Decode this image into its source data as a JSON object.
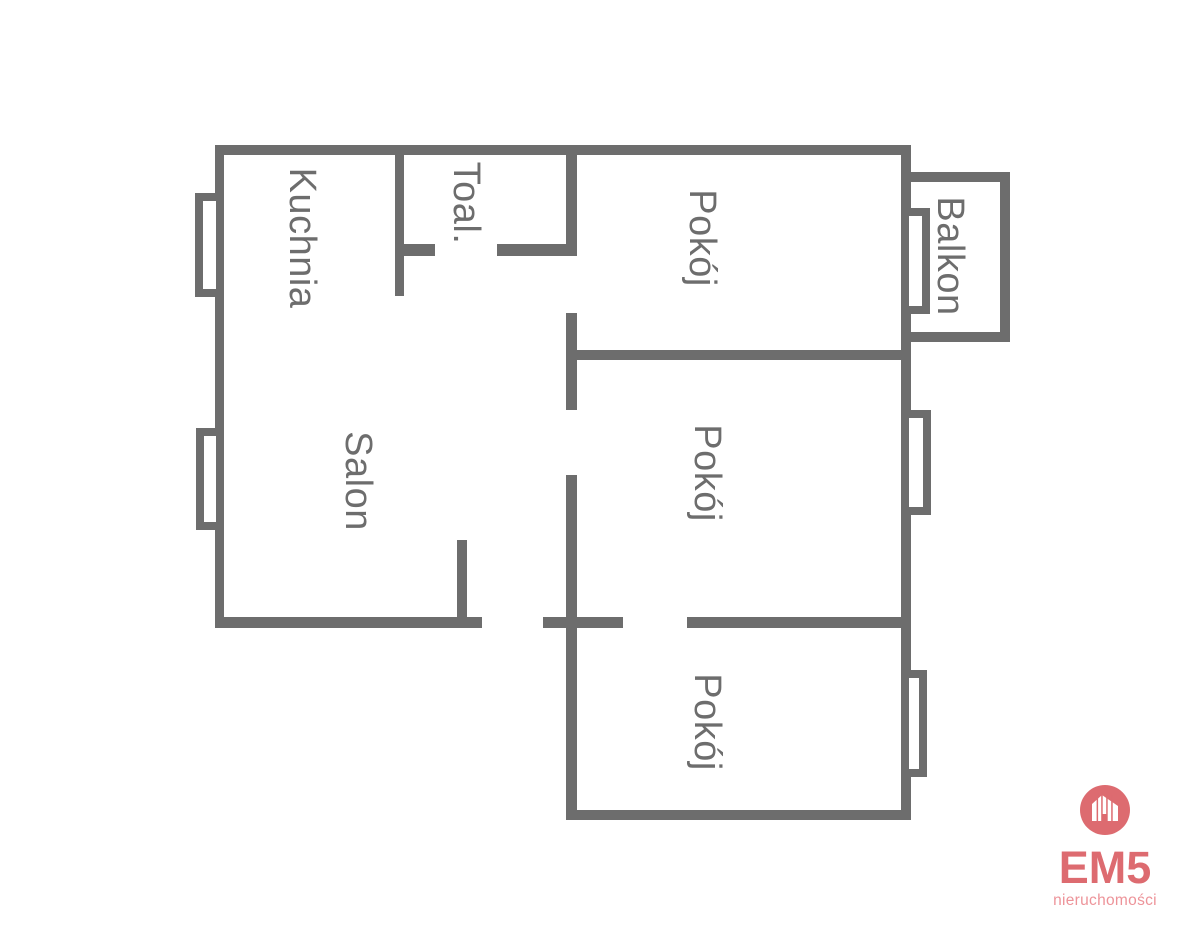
{
  "plan": {
    "background": "#ffffff",
    "wall_color": "#6d6d6d",
    "label_color": "#6d6d6d",
    "rooms": [
      {
        "id": "kuchnia",
        "label": "Kuchnia",
        "cx": 302,
        "cy": 238
      },
      {
        "id": "toaleta",
        "label": "Toal.",
        "cx": 466,
        "cy": 203
      },
      {
        "id": "salon",
        "label": "Salon",
        "cx": 358,
        "cy": 481
      },
      {
        "id": "pokoj-1",
        "label": "Pokój",
        "cx": 702,
        "cy": 238
      },
      {
        "id": "pokoj-2",
        "label": "Pokój",
        "cx": 707,
        "cy": 473
      },
      {
        "id": "pokoj-3",
        "label": "Pokój",
        "cx": 707,
        "cy": 722
      },
      {
        "id": "balkon",
        "label": "Balkon",
        "cx": 950,
        "cy": 256
      }
    ],
    "walls": [
      {
        "name": "exterior-top",
        "x": 215,
        "y": 145,
        "w": 696,
        "h": 10
      },
      {
        "name": "exterior-left",
        "x": 215,
        "y": 145,
        "w": 9,
        "h": 483
      },
      {
        "name": "exterior-right",
        "x": 901,
        "y": 145,
        "w": 10,
        "h": 675
      },
      {
        "name": "kuchnia-toal-divider",
        "x": 395,
        "y": 155,
        "w": 9,
        "h": 141
      },
      {
        "name": "toal-bottom-left",
        "x": 395,
        "y": 244,
        "w": 40,
        "h": 12
      },
      {
        "name": "toal-bottom-right",
        "x": 497,
        "y": 244,
        "w": 80,
        "h": 12
      },
      {
        "name": "hall-wall-top",
        "x": 566,
        "y": 155,
        "w": 11,
        "h": 101
      },
      {
        "name": "hall-wall-mid",
        "x": 566,
        "y": 313,
        "w": 11,
        "h": 97
      },
      {
        "name": "hall-wall-bottom",
        "x": 566,
        "y": 475,
        "w": 11,
        "h": 345
      },
      {
        "name": "pokoj1-pokoj2-divider",
        "x": 566,
        "y": 350,
        "w": 335,
        "h": 10
      },
      {
        "name": "salon-bottom",
        "x": 215,
        "y": 617,
        "w": 267,
        "h": 11
      },
      {
        "name": "entry-bottom",
        "x": 543,
        "y": 617,
        "w": 80,
        "h": 11
      },
      {
        "name": "pokoj2-pokoj3-divider",
        "x": 687,
        "y": 617,
        "w": 214,
        "h": 11
      },
      {
        "name": "pokoj3-bottom",
        "x": 566,
        "y": 810,
        "w": 345,
        "h": 10
      },
      {
        "name": "salon-entry-stub",
        "x": 457,
        "y": 540,
        "w": 10,
        "h": 88
      },
      {
        "name": "balkon-top",
        "x": 911,
        "y": 172,
        "w": 99,
        "h": 10
      },
      {
        "name": "balkon-right",
        "x": 1000,
        "y": 172,
        "w": 10,
        "h": 170
      },
      {
        "name": "balkon-bottom",
        "x": 911,
        "y": 332,
        "w": 99,
        "h": 10
      }
    ],
    "windows": [
      {
        "name": "kuchnia-window",
        "x": 195,
        "y": 193,
        "w": 29,
        "h": 104
      },
      {
        "name": "salon-window",
        "x": 196,
        "y": 428,
        "w": 28,
        "h": 102
      },
      {
        "name": "balkon-window",
        "x": 901,
        "y": 208,
        "w": 29,
        "h": 106
      },
      {
        "name": "pokoj2-window",
        "x": 901,
        "y": 410,
        "w": 30,
        "h": 105
      },
      {
        "name": "pokoj3-window",
        "x": 901,
        "y": 670,
        "w": 26,
        "h": 107
      }
    ]
  },
  "logo": {
    "brand": "EM5",
    "tagline": "nieruchomości",
    "icon": "house-icon",
    "accent": "#dd6b70",
    "tagline_color": "#ed9399"
  }
}
